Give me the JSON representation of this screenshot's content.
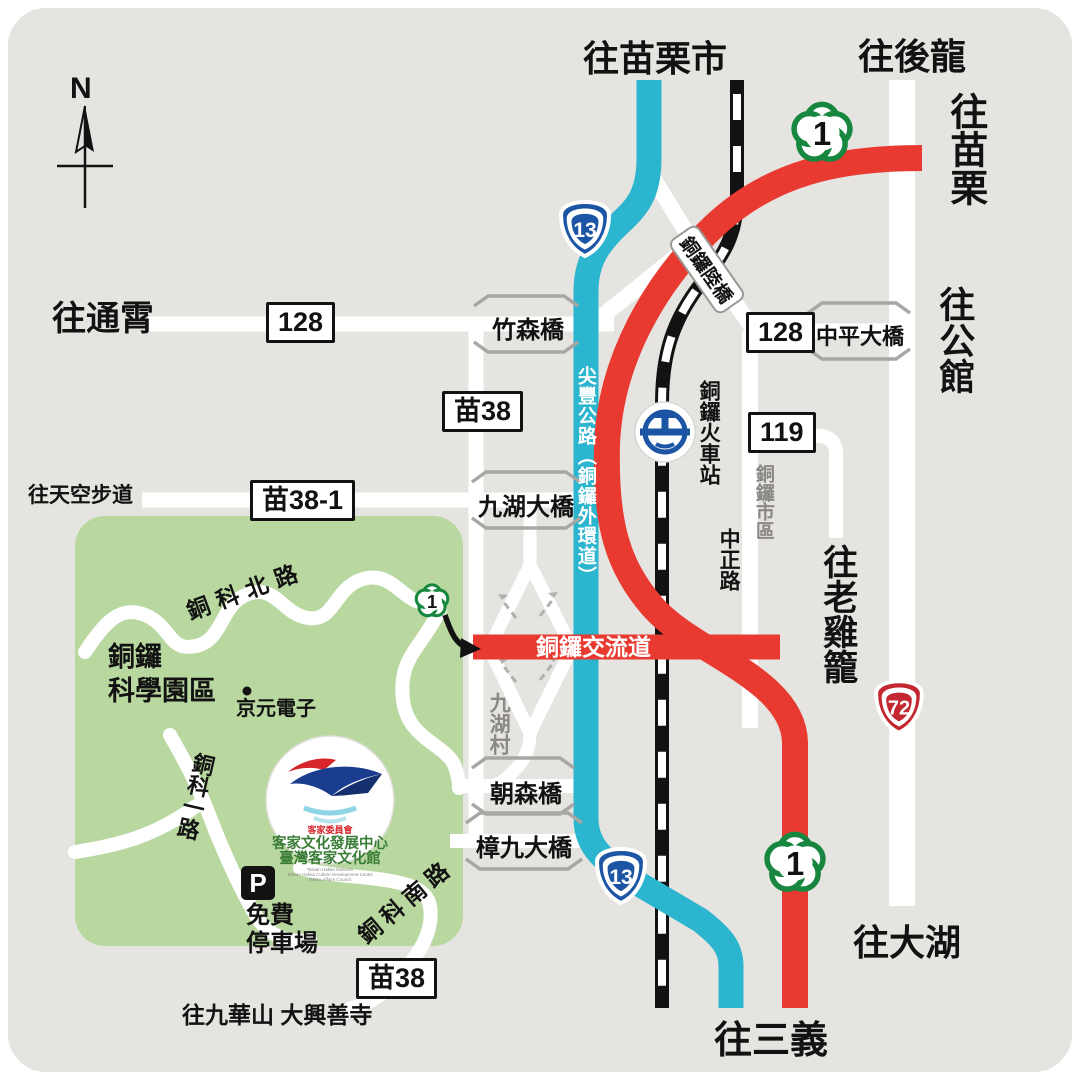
{
  "compass": {
    "north": "N"
  },
  "colors": {
    "panel": "#e6e4e0",
    "road_white": "#ffffff",
    "provincial_13_cyan": "#2cb5ce",
    "highway_1_red": "#e83a30",
    "park_green": "#b9d8a0",
    "rail_black": "#121212",
    "shield_green": "#17873f",
    "shield_blue": "#1d55a5",
    "shield_red": "#c3272f"
  },
  "destinations": {
    "miaoli_city": "往苗栗市",
    "houlong": "往後龍",
    "miaoli": "往苗栗",
    "tongxiao": "往通霄",
    "gongguan": "往公館",
    "skywalk": "往天空步道",
    "laojilong": "往老雞籠",
    "dahu": "往大湖",
    "sanyi": "往三義",
    "jiuhuashan_temple": "往九華山 大興善寺"
  },
  "shields": {
    "tai1": "1",
    "tai13": "13",
    "tai72": "72"
  },
  "signs": {
    "c128": "128",
    "c119": "119",
    "m38": "苗38",
    "m38_1": "苗38-1"
  },
  "roads": {
    "jianfeng_vertical": "尖豐公路（銅鑼外環道）",
    "interchange": "銅鑼交流道",
    "zhongzheng_rd": "中正路",
    "tongke_north_rd": "銅科北路",
    "tongke_1st_rd": "銅科一路",
    "tongke_south_rd": "銅科南路",
    "tongluo_overpass": "銅鑼陸橋"
  },
  "bridges": {
    "zhusen": "竹森橋",
    "jiuhu_big": "九湖大橋",
    "zhongping_big": "中平大橋",
    "chaosen": "朝森橋",
    "zhangjiu_big": "樟九大橋"
  },
  "places": {
    "train_station": "銅鑼火車站",
    "downtown": "銅鑼市區",
    "jiuhu_village": "九湖村",
    "science_park_l1": "銅鑼",
    "science_park_l2": "科學園區",
    "kyec": "京元電子",
    "parking_p": "P",
    "parking_l1": "免費",
    "parking_l2": "停車場"
  },
  "logo": {
    "council": "客家委員會",
    "line1": "客家文化發展中心",
    "line2": "臺灣客家文化館",
    "en1": "Taiwan Hakka Museum",
    "en2": "Taiwan Hakka Culture Development Center",
    "en3": "Hakka Affairs Council"
  }
}
